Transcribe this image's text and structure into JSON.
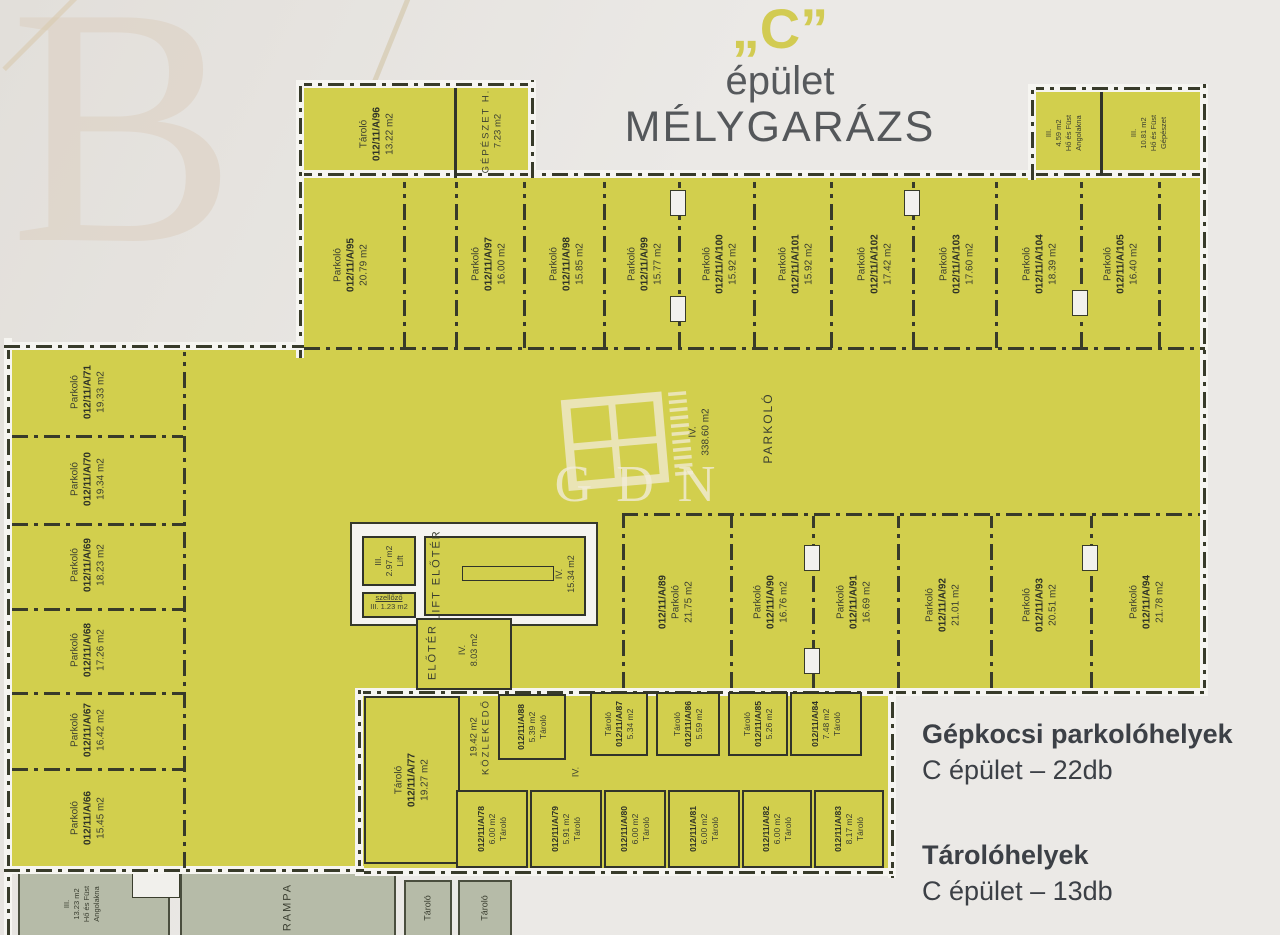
{
  "title": {
    "letter": "„C”",
    "building": "épület",
    "garage": "MÉLYGARÁZS"
  },
  "watermark": {
    "corner": "B",
    "logo": "GDN"
  },
  "summary": {
    "parking_title": "Gépkocsi parkolóhelyek",
    "parking_count": "C épület – 22db",
    "storage_title": "Tárolóhelyek",
    "storage_count": "C épület – 13db"
  },
  "areas": {
    "central": {
      "num": "IV.",
      "size": "338.60 m2",
      "name": "PARKOLÓ"
    },
    "gepeszet": {
      "name": "GÉPÉSZET H.",
      "size": "7.23 m2"
    },
    "lift": {
      "num": "III.",
      "size": "2.97 m2",
      "name": "Lift"
    },
    "szellozo": {
      "name": "szellőző",
      "detail": "III. 1.23 m2"
    },
    "lift_eloter": {
      "name": "LIFT ELŐTÉR",
      "num": "IV.",
      "size": "15.34 m2"
    },
    "eloter": {
      "name": "ELŐTÉR",
      "num": "IV.",
      "size": "8.03 m2"
    },
    "kozlekedo": {
      "size": "19.42 m2",
      "name": "KÖZLEKEDŐ",
      "num": "IV."
    },
    "hf_small": {
      "num": "III.",
      "size": "4.59 m2",
      "l1": "Hő és Füst",
      "l2": "Angolakna"
    },
    "hf_large": {
      "num": "III.",
      "size": "10.81 m2",
      "l1": "Hő és Füst",
      "l2": "Gépészet"
    },
    "hf_bottom": {
      "num": "III.",
      "size": "13.23 m2",
      "l1": "Hő és Füst",
      "l2": "Angolakna"
    },
    "rampa": "RAMPA",
    "gray_storage_1": "Tároló",
    "gray_storage_2": "Tároló"
  },
  "rooms": {
    "p66": {
      "type": "Parkoló",
      "id": "012/11/A/66",
      "area": "15.45 m2"
    },
    "p67": {
      "type": "Parkoló",
      "id": "012/11/A/67",
      "area": "16.42 m2"
    },
    "p68": {
      "type": "Parkoló",
      "id": "012/11/A/68",
      "area": "17.26 m2"
    },
    "p69": {
      "type": "Parkoló",
      "id": "012/11/A/69",
      "area": "18.23 m2"
    },
    "p70": {
      "type": "Parkoló",
      "id": "012/11/A/70",
      "area": "19.34 m2"
    },
    "p71": {
      "type": "Parkoló",
      "id": "012/11/A/71",
      "area": "19.33 m2"
    },
    "p89": {
      "type": "Parkoló",
      "id": "012/11/A/89",
      "area": "21.75 m2"
    },
    "p90": {
      "type": "Parkoló",
      "id": "012/11/A/90",
      "area": "16.76 m2"
    },
    "p91": {
      "type": "Parkoló",
      "id": "012/11/A/91",
      "area": "16.69 m2"
    },
    "p92": {
      "type": "Parkoló",
      "id": "012/11/A/92",
      "area": "21.01 m2"
    },
    "p93": {
      "type": "Parkoló",
      "id": "012/11/A/93",
      "area": "20.51 m2"
    },
    "p94": {
      "type": "Parkoló",
      "id": "012/11/A/94",
      "area": "21.78 m2"
    },
    "p95": {
      "type": "Parkoló",
      "id": "012/11/A/95",
      "area": "20.79 m2"
    },
    "p97": {
      "type": "Parkoló",
      "id": "012/11/A/97",
      "area": "16.00 m2"
    },
    "p98": {
      "type": "Parkoló",
      "id": "012/11/A/98",
      "area": "15.85 m2"
    },
    "p99": {
      "type": "Parkoló",
      "id": "012/11/A/99",
      "area": "15.77 m2"
    },
    "p100": {
      "type": "Parkoló",
      "id": "012/11/A/100",
      "area": "15.92 m2"
    },
    "p101": {
      "type": "Parkoló",
      "id": "012/11/A/101",
      "area": "15.92 m2"
    },
    "p102": {
      "type": "Parkoló",
      "id": "012/11/A/102",
      "area": "17.42 m2"
    },
    "p103": {
      "type": "Parkoló",
      "id": "012/11/A/103",
      "area": "17.60 m2"
    },
    "p104": {
      "type": "Parkoló",
      "id": "012/11/A/104",
      "area": "18.39 m2"
    },
    "p105": {
      "type": "Parkoló",
      "id": "012/11/A/105",
      "area": "16.40 m2"
    },
    "t77": {
      "type": "Tároló",
      "id": "012/11/A/77",
      "area": "19.27 m2"
    },
    "t78": {
      "type": "Tároló",
      "id": "012/11/A/78",
      "area": "6.00 m2"
    },
    "t79": {
      "type": "Tároló",
      "id": "012/11/A/79",
      "area": "5.91 m2"
    },
    "t80": {
      "type": "Tároló",
      "id": "012/11/A/80",
      "area": "6.00 m2"
    },
    "t81": {
      "type": "Tároló",
      "id": "012/11/A/81",
      "area": "6.00 m2"
    },
    "t82": {
      "type": "Tároló",
      "id": "012/11/A/82",
      "area": "6.00 m2"
    },
    "t83": {
      "type": "Tároló",
      "id": "012/11/A/83",
      "area": "8.17 m2"
    },
    "t84": {
      "type": "Tároló",
      "id": "012/11/A/84",
      "area": "7.48 m2"
    },
    "t85": {
      "type": "Tároló",
      "id": "012/11/A/85",
      "area": "5.26 m2"
    },
    "t86": {
      "type": "Tároló",
      "id": "012/11/A/86",
      "area": "5.59 m2"
    },
    "t87": {
      "type": "Tároló",
      "id": "012/11/A/87",
      "area": "5.34 m2"
    },
    "t88": {
      "type": "Tároló",
      "id": "012/11/A/88",
      "area": "5.39 m2"
    },
    "t96": {
      "type": "Tároló",
      "id": "012/11/A/96",
      "area": "13.22 m2"
    }
  }
}
